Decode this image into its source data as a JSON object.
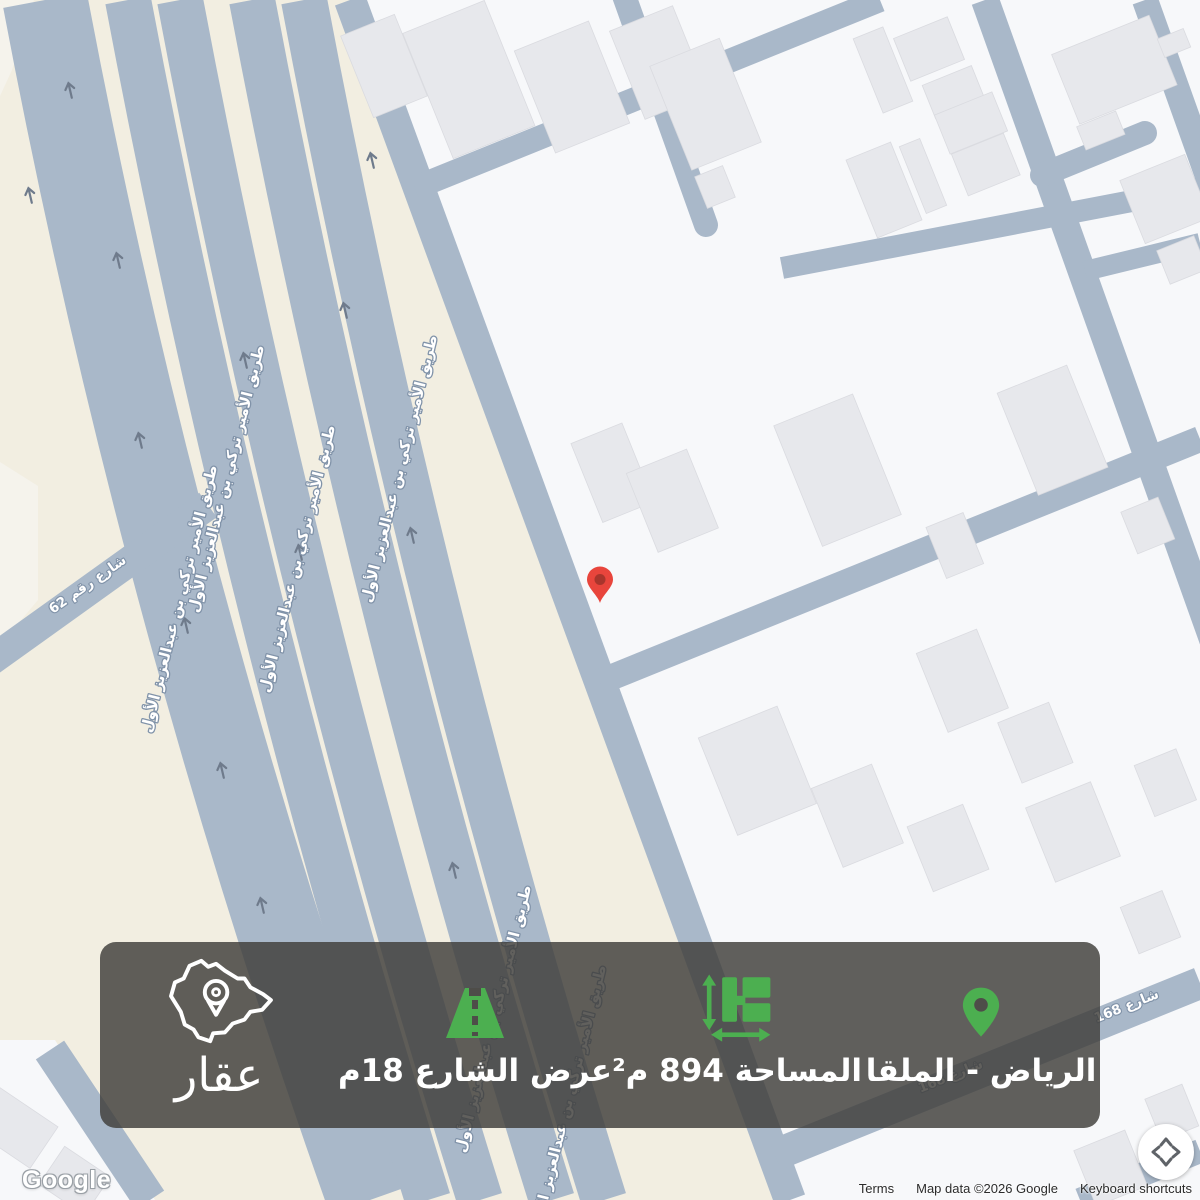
{
  "banner": {
    "location_label": "الرياض - الملقا",
    "area_label": "المساحة 894 م²",
    "street_width_label": "عرض الشارع 18م",
    "brand_name": "عقار",
    "accent_green": "#4caf50",
    "background": "rgba(62,61,57,0.82)"
  },
  "map_labels": {
    "highway": "طريق الأمير تركي بن عبدالعزيز الأول",
    "street_62": "شارع رقم 62",
    "street_168": "شارع 168"
  },
  "marker": {
    "color": "#e8453c"
  },
  "watermark": {
    "google": "Google"
  },
  "attribution": {
    "terms": "Terms",
    "map_data": "Map data ©2026 Google",
    "shortcuts": "Keyboard shortcuts"
  }
}
